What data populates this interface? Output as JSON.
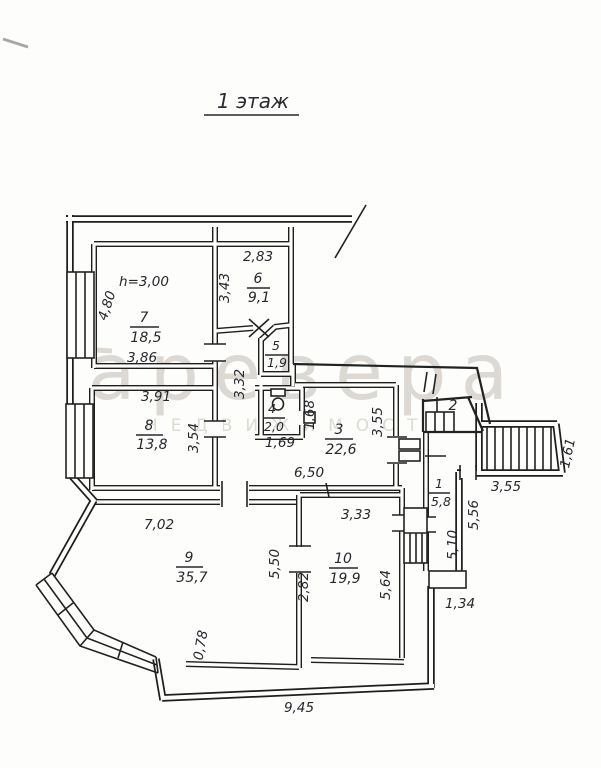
{
  "title": "1 этаж",
  "watermark": {
    "line1": "аревера",
    "line2": "НЕДВИЖИМОСТЬ"
  },
  "note_height": "h=3,00",
  "rooms": {
    "r1": {
      "num": "1",
      "area": "5,8"
    },
    "r2": {
      "num": "2"
    },
    "r3": {
      "num": "3",
      "area": "22,6"
    },
    "r4": {
      "num": "4",
      "area": "2,0"
    },
    "r5": {
      "num": "5",
      "area": "1,9"
    },
    "r6": {
      "num": "6",
      "area": "9,1"
    },
    "r7": {
      "num": "7",
      "area": "18,5"
    },
    "r8": {
      "num": "8",
      "area": "13,8"
    },
    "r9": {
      "num": "9",
      "area": "35,7"
    },
    "r10": {
      "num": "10",
      "area": "19,9"
    }
  },
  "dims": {
    "d283": "2,83",
    "d343": "3,43",
    "d480": "4,80",
    "d386": "3,86",
    "d391": "3,91",
    "d354": "3,54",
    "d332": "3,32",
    "d168": "1,68",
    "d169": "1,69",
    "d355a": "3,55",
    "d650": "6,50",
    "d355b": "3,55",
    "d161": "1,61",
    "d556": "5,56",
    "d510": "5,10",
    "d134": "1,34",
    "d702": "7,02",
    "d550": "5,50",
    "d282": "2,82",
    "d078": "0,78",
    "d333": "3,33",
    "d564": "5,64",
    "d945": "9,45"
  }
}
